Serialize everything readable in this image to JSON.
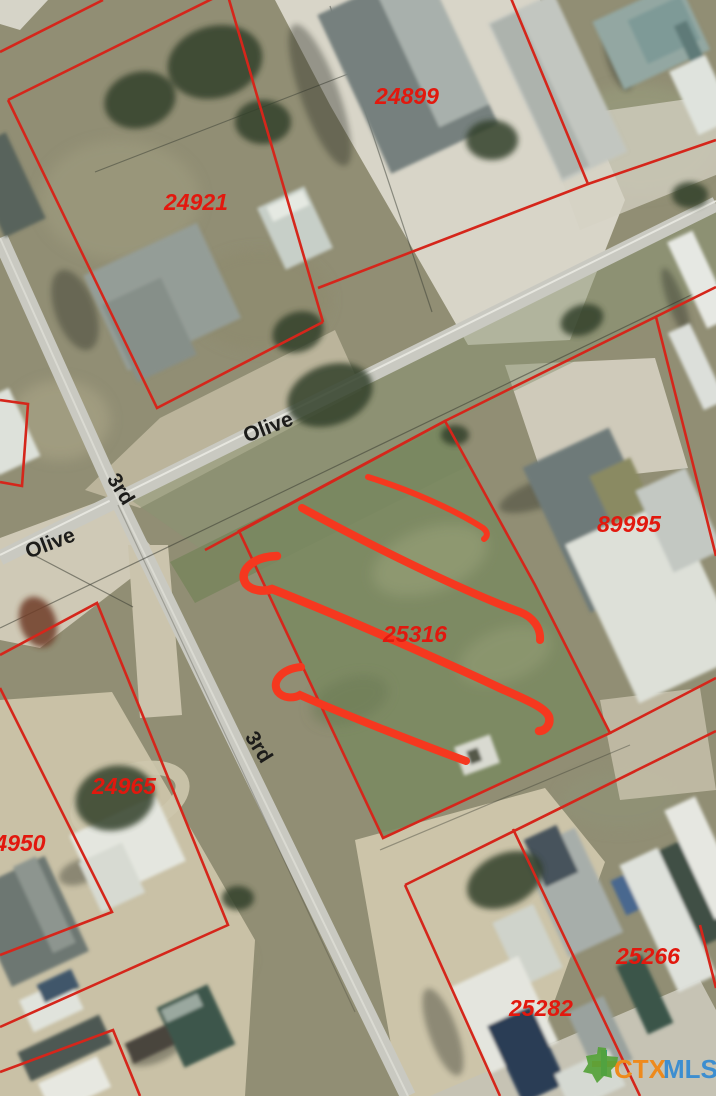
{
  "map": {
    "type": "aerial-parcel-map",
    "parcel_labels": [
      {
        "text": "24899"
      },
      {
        "text": "24921"
      },
      {
        "text": "89995"
      },
      {
        "text": "25316"
      },
      {
        "text": "24965"
      },
      {
        "text": "4950"
      },
      {
        "text": "25266"
      },
      {
        "text": "25282"
      }
    ],
    "street_labels": [
      {
        "text": "Olive"
      },
      {
        "text": "Olive"
      },
      {
        "text": "3rd"
      },
      {
        "text": "3rd"
      }
    ],
    "highlighted_parcel": "25316",
    "colors": {
      "parcel_line": "#d5261b",
      "highlight_stroke": "#f5381f",
      "label_red": "#e2180e",
      "street_label": "#1c1c1a",
      "road": "#c9c9c1",
      "logo_ctx": "#ee8a1c",
      "logo_mls": "#3d8ed0",
      "logo_texas": "#55a238"
    }
  },
  "logo": {
    "prefix": "CTX",
    "suffix": "MLS"
  }
}
